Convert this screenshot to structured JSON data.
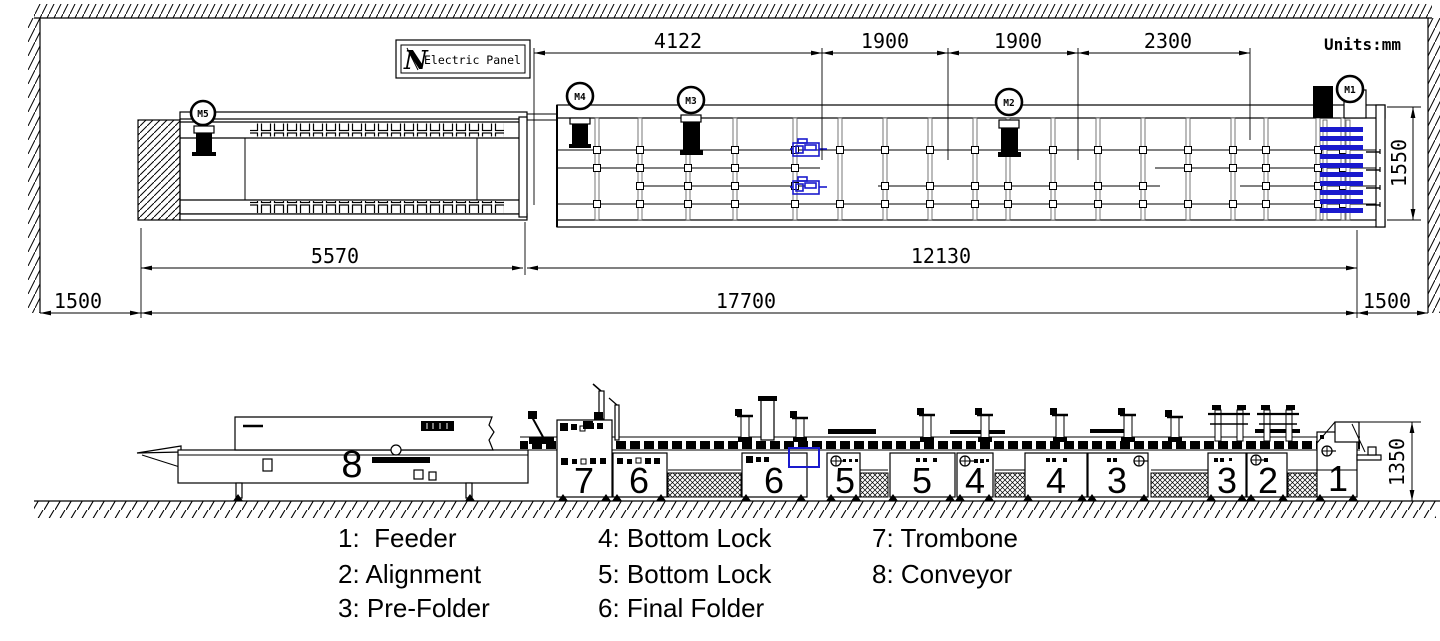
{
  "units_note": "Units:mm",
  "electric_panel": {
    "logo": "N",
    "label": "Electric Panel"
  },
  "plan": {
    "motors": {
      "m1": "M1",
      "m2": "M2",
      "m3": "M3",
      "m4": "M4",
      "m5": "M5"
    },
    "dims": {
      "top": [
        "4122",
        "1900",
        "1900",
        "2300"
      ],
      "conveyor": "5570",
      "machine": "12130",
      "total": "17700",
      "left_clearance": "1500",
      "right_clearance": "1500",
      "width": "1550"
    }
  },
  "elevation": {
    "height": "1350",
    "sections": [
      "8",
      "7",
      "6",
      "6",
      "5",
      "5",
      "4",
      "4",
      "3",
      "3",
      "2",
      "1"
    ]
  },
  "legend": {
    "col1": [
      "1:  Feeder",
      "2: Alignment",
      "3: Pre-Folder"
    ],
    "col2": [
      "4: Bottom Lock",
      "5: Bottom Lock",
      "6: Final Folder"
    ],
    "col3": [
      "7: Trombone",
      "8: Conveyor"
    ]
  },
  "colors": {
    "accent_blue": "#1a1acd",
    "ink": "#000000"
  }
}
